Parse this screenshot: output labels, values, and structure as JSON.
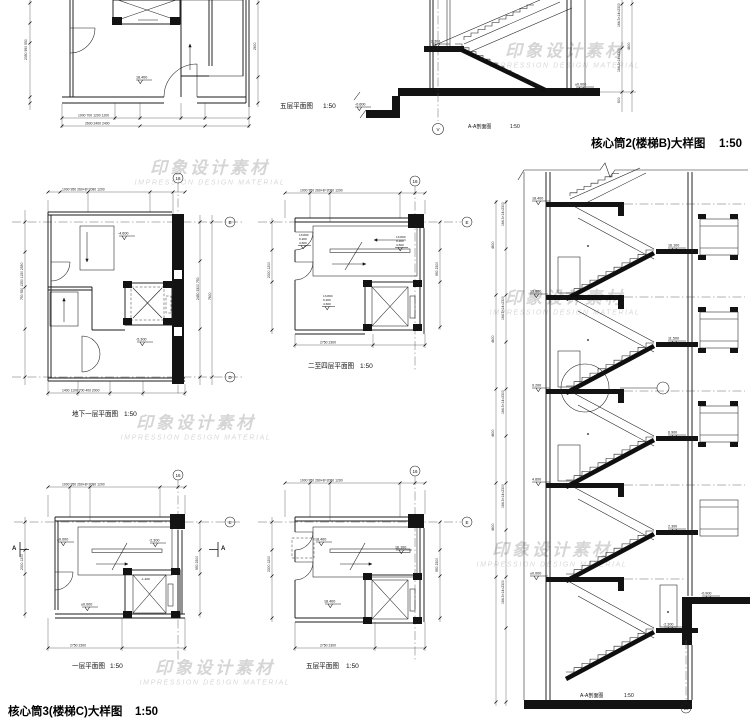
{
  "watermark": {
    "cn": "印象设计素材",
    "en": "IMPRESSION DESIGN MATERIAL"
  },
  "sheet": {
    "title_core2": "核心筒2(楼梯B)大样图",
    "title_core2_scale": "1:50",
    "title_core3": "核心筒3(楼梯C)大样图",
    "title_core3_scale": "1:50"
  },
  "plan_tl": {
    "label": "五层平面图",
    "scale": "1:50",
    "level": "18.400",
    "dims": {
      "bottom1": "1000   700           1200         1200",
      "bottom2": "2600        2400        2400",
      "left": "2350  950  550",
      "right": "2600"
    }
  },
  "section_b": {
    "label": "A-A剖面图",
    "scale": "1:50",
    "axis": "V",
    "levels": {
      "landing": "2.300",
      "floor": "±0.000",
      "entry": "-0.600"
    },
    "dims": {
      "r1": "164.3×14=2300",
      "r2": "4600",
      "r3": "600"
    }
  },
  "plan_bsmt": {
    "label": "地下一层平面图",
    "scale": "1:50",
    "axis_top": "16",
    "axis_e": "E",
    "axis_d": "D",
    "levels": {
      "upper": "-4.600",
      "floor": "-5.300"
    },
    "dims": {
      "top": "1000  950  260×8=2080  1200",
      "bottom": "1400 1100 700 400 2000",
      "left": "750 550 1350 1150 2550",
      "right": "2450  3300  750",
      "right_total": "7600"
    }
  },
  "plan_f24": {
    "label": "二至四层平面图",
    "scale": "1:50",
    "axis_top": "16",
    "axis_e": "E",
    "levels": [
      "13.800",
      "9.200",
      "4.600"
    ],
    "dims": {
      "top": "1000  950  260×8=2080  1200",
      "bottom": "2750          2300",
      "left": "2300  1200",
      "right": "950  2300"
    }
  },
  "plan_f1": {
    "label": "一层平面图",
    "scale": "1:50",
    "axis_top": "16",
    "axis_e": "E",
    "cut": "A",
    "levels": {
      "floor": "±0.000",
      "down": "-2.300",
      "floor2": "±0.000",
      "pit": "-1.400"
    },
    "dims": {
      "top": "1000  950  260×8=2080  1200",
      "bottom": "2750          2300",
      "left": "2300  1200",
      "right": "950  2300"
    }
  },
  "plan_f5": {
    "label": "五层平面图",
    "scale": "1:50",
    "axis_top": "16",
    "axis_e": "E",
    "levels": {
      "floor": "18.400",
      "landing": "16.100",
      "floor2": "18.400"
    },
    "dims": {
      "top": "1000  950  260×8=2080  1200",
      "bottom": "2750          2300",
      "left": "2300  1200",
      "right": "950  2300"
    }
  },
  "section_c": {
    "label": "A-A剖面图",
    "scale": "1:50",
    "axis": "16",
    "floors": [
      "18.400",
      "13.800",
      "9.200",
      "4.600",
      "±0.000"
    ],
    "landings": [
      "16.100",
      "11.500",
      "6.900",
      "2.300",
      "-2.300"
    ],
    "ground": "-0.900",
    "dims": {
      "story": "4600",
      "run": "164.3×14=2300"
    }
  }
}
